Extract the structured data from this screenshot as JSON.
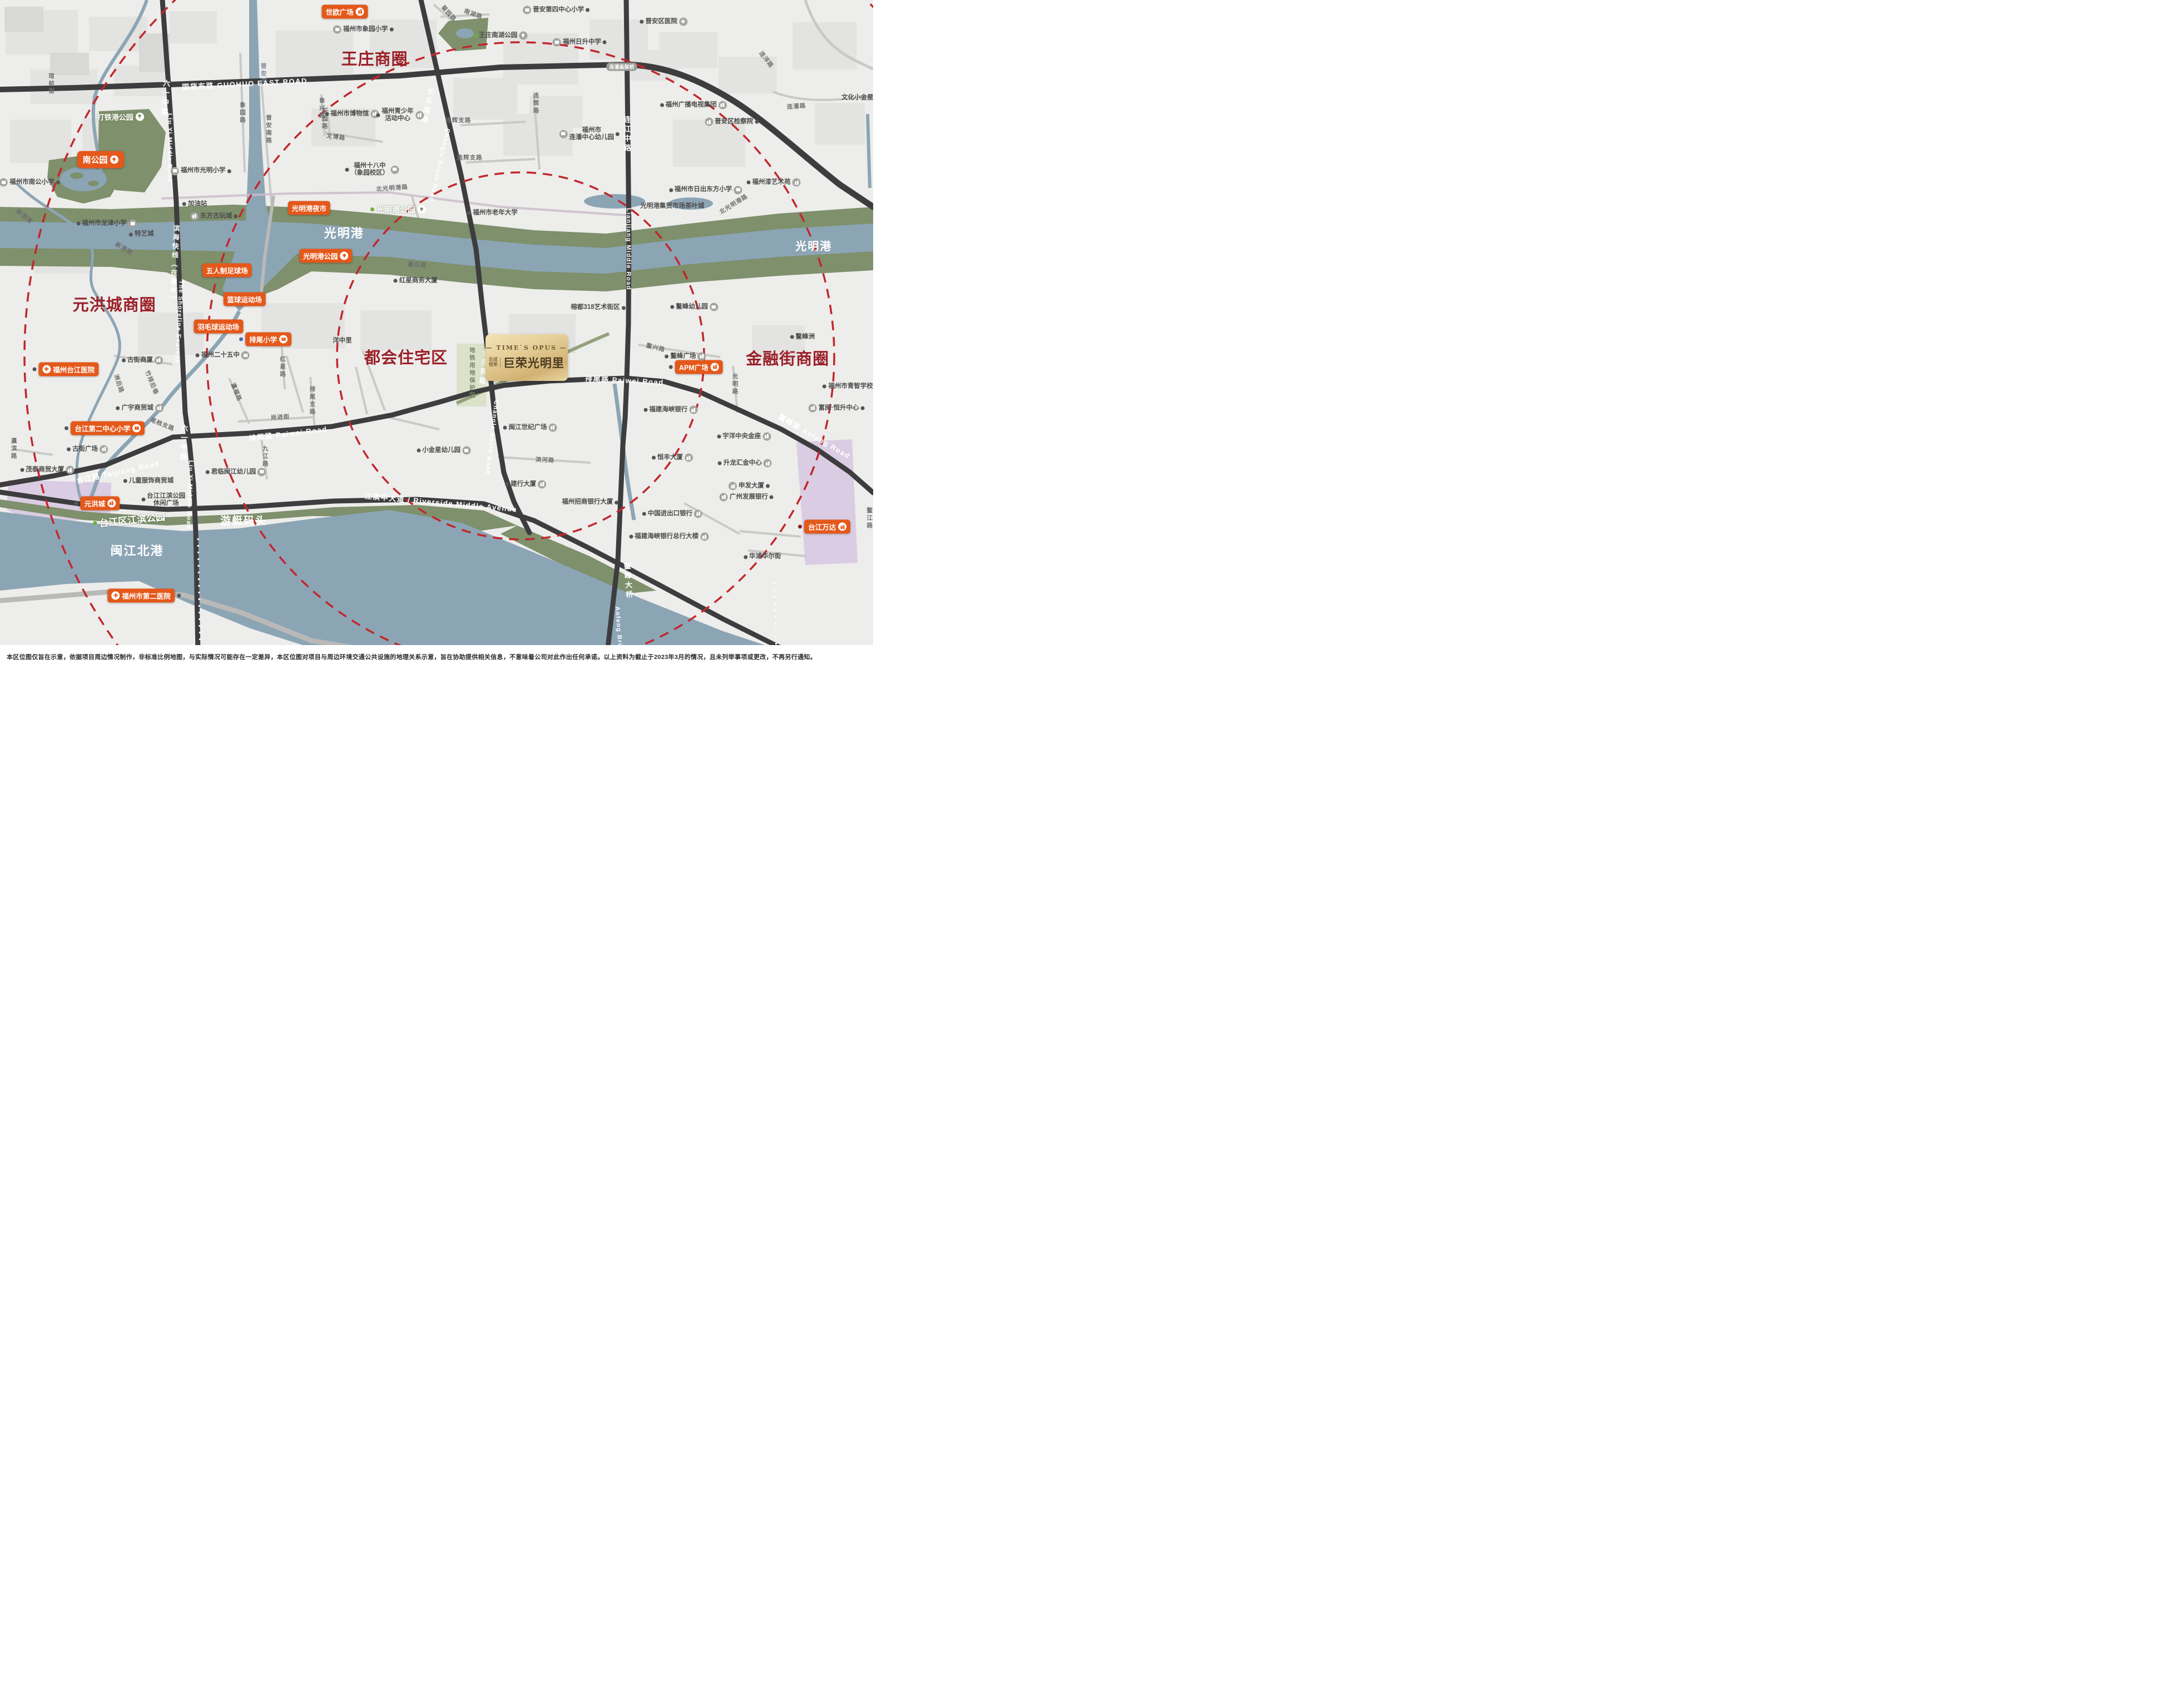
{
  "project": {
    "en_line": "— TIME`S OPUS —",
    "logo_top": "巨成",
    "logo_bottom": "恒荣",
    "name": "巨荣光明里",
    "x": 60.3,
    "y": 53.1
  },
  "disclaimer": "本区位图仅旨在示意，依据项目周边情况制作，非标准比例地图，与实际情况可能存在一定差异，本区位图对项目与周边环境交通公共设施的地理关系示意，旨在协助提供相关信息，不意味着公司对此作出任何承诺。以上资料为截止于2023年3月的情况，且未列举事项或更改，不再另行通知。",
  "colors": {
    "badge_orange": "#e4581a",
    "district_red": "#9b2028",
    "dash_red": "#c1272d",
    "water": "#8ca5b5",
    "park": "#7e906c",
    "road_dark": "#3d3d3f",
    "gold": "#d2b272"
  },
  "districts": [
    {
      "t": "王庄商圈",
      "x": 42.9,
      "y": 8.6
    },
    {
      "t": "元洪城商圈",
      "x": 13.1,
      "y": 45.1
    },
    {
      "t": "都会住宅区",
      "x": 46.5,
      "y": 52.9
    },
    {
      "t": "金融街商圈",
      "x": 90.2,
      "y": 53.1
    }
  ],
  "water_labels": [
    {
      "t": "光明港",
      "x": 39.4,
      "y": 34.5,
      "fs": 22
    },
    {
      "t": "光明港",
      "x": 93.2,
      "y": 36.4,
      "fs": 20
    },
    {
      "t": "闽江北港",
      "x": 15.7,
      "y": 81.7,
      "fs": 22
    },
    {
      "t": "游艇码头",
      "x": 27.9,
      "y": 77.2,
      "fs": 19
    }
  ],
  "park_labels": [
    {
      "t": "打铁港公园",
      "x": 13.8,
      "y": 17.3,
      "fs": 13,
      "icon": "tree"
    },
    {
      "t": "光明港公园",
      "x": 45.6,
      "y": 31.1,
      "fs": 14,
      "icon": "tree",
      "dc": "#6fae3e"
    },
    {
      "t": "台江区江滨公园",
      "x": 14.8,
      "y": 77.1,
      "fs": 17,
      "rot": -6,
      "dc": "#6fae3e"
    }
  ],
  "badges": [
    {
      "t": "世欧广场",
      "x": 39.5,
      "y": 1.7,
      "icon": "building",
      "is": "r"
    },
    {
      "t": "南公园",
      "x": 11.5,
      "y": 23.7,
      "icon": "tree",
      "is": "r",
      "size": "l"
    },
    {
      "t": "光明港夜市",
      "x": 35.4,
      "y": 30.9
    },
    {
      "t": "光明港公园",
      "x": 37.3,
      "y": 38.0,
      "icon": "tree",
      "is": "r"
    },
    {
      "t": "五人制足球场",
      "x": 26.0,
      "y": 40.1
    },
    {
      "t": "篮球运动场",
      "x": 28.0,
      "y": 44.4
    },
    {
      "t": "羽毛球运动场",
      "x": 25.0,
      "y": 48.5
    },
    {
      "t": "排尾小学",
      "x": 30.4,
      "y": 50.4,
      "icon": "book",
      "is": "r",
      "dot": "l",
      "dc": "#3a6fb0"
    },
    {
      "t": "福州台江医院",
      "x": 7.5,
      "y": 54.8,
      "icon": "cross",
      "is": "l",
      "dot": "l"
    },
    {
      "t": "台江第二中心小学",
      "x": 12.0,
      "y": 63.6,
      "icon": "book",
      "is": "r",
      "dot": "l"
    },
    {
      "t": "元洪城",
      "x": 11.1,
      "y": 74.7,
      "icon": "building",
      "is": "r",
      "dot": "l"
    },
    {
      "t": "福州市第二医院",
      "x": 16.5,
      "y": 88.4,
      "icon": "cross",
      "is": "l",
      "dot": "r"
    },
    {
      "t": "APM广场",
      "x": 79.7,
      "y": 54.5,
      "icon": "building",
      "is": "r",
      "dot": "l"
    },
    {
      "t": "台江万达",
      "x": 94.4,
      "y": 78.2,
      "icon": "building",
      "is": "r",
      "dot": "l",
      "dc": "#8b1f1f"
    }
  ],
  "pois": [
    {
      "t": "福州市象园小学",
      "x": 41.6,
      "y": 4.4,
      "icon": "book",
      "is": "l",
      "dot": "r"
    },
    {
      "t": "福州市博物馆",
      "x": 40.3,
      "y": 16.9,
      "icon": "building",
      "is": "r",
      "dot": "l"
    },
    {
      "t": "福州青少年\n活动中心",
      "x": 45.8,
      "y": 17.1,
      "icon": "building",
      "is": "r",
      "dot": "l"
    },
    {
      "t": "福州十八中\n（象园校区）",
      "x": 42.6,
      "y": 25.2,
      "icon": "book",
      "is": "r",
      "dot": "l"
    },
    {
      "t": "福州市光明小学",
      "x": 23.0,
      "y": 25.4,
      "icon": "book",
      "is": "l",
      "dot": "r"
    },
    {
      "t": "晋安第四中心小学",
      "x": 63.7,
      "y": 1.5,
      "icon": "book",
      "is": "l",
      "dot": "r"
    },
    {
      "t": "福州日升中学",
      "x": 66.4,
      "y": 6.3,
      "icon": "book",
      "is": "l",
      "dot": "r"
    },
    {
      "t": "王庄南湖公园",
      "x": 57.3,
      "y": 5.3,
      "icon": "tree",
      "is": "r",
      "dot": "l",
      "dc": "#6fae3e"
    },
    {
      "t": "福州市\n连潘中心幼儿园",
      "x": 67.5,
      "y": 19.9,
      "icon": "book",
      "is": "l",
      "dot": "r"
    },
    {
      "t": "晋安区医院",
      "x": 76.0,
      "y": 3.2,
      "icon": "cross",
      "is": "r",
      "dot": "l"
    },
    {
      "t": "福州广播电视集团",
      "x": 79.4,
      "y": 15.6,
      "icon": "building",
      "is": "r",
      "dot": "l"
    },
    {
      "t": "晋安区检察院",
      "x": 83.8,
      "y": 18.1,
      "icon": "building",
      "is": "l",
      "dot": "r"
    },
    {
      "t": "文化小金星幼儿园",
      "x": 99.3,
      "y": 14.5
    },
    {
      "t": "福州漆艺术苑",
      "x": 88.6,
      "y": 27.1,
      "icon": "building",
      "is": "r",
      "dot": "l"
    },
    {
      "t": "福州市日出东方小学",
      "x": 80.8,
      "y": 28.2,
      "icon": "book",
      "is": "r",
      "dot": "l"
    },
    {
      "t": "光明港集贸市场茶叶城",
      "x": 77.0,
      "y": 30.6
    },
    {
      "t": "鳌峰幼儿园",
      "x": 79.5,
      "y": 45.6,
      "icon": "book",
      "is": "r",
      "dot": "l"
    },
    {
      "t": "鳌峰洲",
      "x": 91.9,
      "y": 50.0,
      "dot": "l"
    },
    {
      "t": "福州市老年大学",
      "x": 56.4,
      "y": 31.6,
      "dot": "l"
    },
    {
      "t": "榕都318艺术街区",
      "x": 68.5,
      "y": 45.7,
      "dot": "r"
    },
    {
      "t": "加油站",
      "x": 22.3,
      "y": 30.3,
      "dot": "l"
    },
    {
      "t": "东方古玩城",
      "x": 24.5,
      "y": 32.1,
      "icon": "building",
      "is": "l",
      "dot": "r"
    },
    {
      "t": "福州市南公小学",
      "x": 3.4,
      "y": 27.1,
      "icon": "book",
      "is": "l",
      "dot": "r"
    },
    {
      "t": "福州市龙津小学",
      "x": 12.2,
      "y": 33.2,
      "icon": "book",
      "is": "r",
      "dot": "l"
    },
    {
      "t": "特艺城",
      "x": 16.2,
      "y": 34.8,
      "dot": "l"
    },
    {
      "t": "古街商厦",
      "x": 16.3,
      "y": 53.5,
      "icon": "building",
      "is": "r",
      "dot": "l"
    },
    {
      "t": "广宇商贸城",
      "x": 16.0,
      "y": 60.6,
      "icon": "building",
      "is": "r",
      "dot": "l"
    },
    {
      "t": "古街广场",
      "x": 10.0,
      "y": 66.7,
      "icon": "building",
      "is": "r",
      "dot": "l"
    },
    {
      "t": "茂泰商贸大厦",
      "x": 5.4,
      "y": 69.8,
      "icon": "building",
      "is": "r",
      "dot": "l"
    },
    {
      "t": "儿童服饰商贸城",
      "x": 17.0,
      "y": 71.4,
      "dot": "l"
    },
    {
      "t": "台江江滨公园\n休闲广场",
      "x": 18.7,
      "y": 74.2,
      "dot": "l"
    },
    {
      "t": "君临闽江幼儿园",
      "x": 27.0,
      "y": 70.1,
      "icon": "book",
      "is": "r",
      "dot": "l"
    },
    {
      "t": "福州二十五中",
      "x": 25.5,
      "y": 52.8,
      "icon": "book",
      "is": "r",
      "dot": "l"
    },
    {
      "t": "洋中里",
      "x": 39.2,
      "y": 50.6
    },
    {
      "t": "红星商务大厦",
      "x": 47.6,
      "y": 41.7,
      "dot": "l"
    },
    {
      "t": "闽江世纪广场",
      "x": 60.7,
      "y": 63.5,
      "icon": "building",
      "is": "r",
      "dot": "l"
    },
    {
      "t": "建行大厦",
      "x": 60.2,
      "y": 71.9,
      "icon": "building",
      "is": "r",
      "dot": "l"
    },
    {
      "t": "福州招商银行大厦",
      "x": 67.6,
      "y": 74.6,
      "dot": "r"
    },
    {
      "t": "小金星幼儿园",
      "x": 50.8,
      "y": 66.9,
      "icon": "book",
      "is": "r",
      "dot": "l"
    },
    {
      "t": "福建海峡银行",
      "x": 76.8,
      "y": 60.9,
      "icon": "building",
      "is": "r",
      "dot": "l"
    },
    {
      "t": "富闽·恒升中心",
      "x": 95.8,
      "y": 60.6,
      "icon": "building",
      "is": "l",
      "dot": "r"
    },
    {
      "t": "福州市青智学校",
      "x": 97.1,
      "y": 57.4,
      "dot": "l"
    },
    {
      "t": "宇洋中央金座",
      "x": 85.2,
      "y": 64.8,
      "icon": "building",
      "is": "r",
      "dot": "l"
    },
    {
      "t": "恒丰大厦",
      "x": 77.0,
      "y": 68.0,
      "icon": "building",
      "is": "r",
      "dot": "l"
    },
    {
      "t": "升龙汇金中心",
      "x": 85.3,
      "y": 68.8,
      "icon": "building",
      "is": "r",
      "dot": "l"
    },
    {
      "t": "申发大厦",
      "x": 85.8,
      "y": 72.2,
      "icon": "building",
      "is": "l",
      "dot": "r"
    },
    {
      "t": "广州发展银行",
      "x": 85.5,
      "y": 73.8,
      "icon": "building",
      "is": "l",
      "dot": "r"
    },
    {
      "t": "中国进出口银行",
      "x": 77.0,
      "y": 76.3,
      "icon": "building",
      "is": "r",
      "dot": "l"
    },
    {
      "t": "福建海峡银行总行大楼",
      "x": 76.6,
      "y": 79.7,
      "icon": "building",
      "is": "r",
      "dot": "l"
    },
    {
      "t": "华浦华尔街",
      "x": 87.3,
      "y": 82.7,
      "dot": "l"
    },
    {
      "t": "鳌峰广场",
      "x": 78.5,
      "y": 52.9,
      "icon": "building",
      "is": "r",
      "dot": "l"
    }
  ],
  "street_labels": [
    {
      "t": "琯前街",
      "x": 5.9,
      "y": 12.5,
      "v": 1
    },
    {
      "t": "晋安河",
      "x": 30.2,
      "y": 11.0,
      "v": 1,
      "c": "#7f8d99"
    },
    {
      "t": "象园路",
      "x": 27.8,
      "y": 16.8,
      "v": 1
    },
    {
      "t": "晋安南路",
      "x": 30.8,
      "y": 19.2,
      "v": 1
    },
    {
      "t": "象兴路",
      "x": 36.9,
      "y": 16.1,
      "v": 1
    },
    {
      "t": "乐园路",
      "x": 37.2,
      "y": 17.7,
      "v": 1
    },
    {
      "t": "文博路",
      "x": 38.5,
      "y": 20.3,
      "rot": 8
    },
    {
      "t": "菊园路",
      "x": 51.4,
      "y": 2.0,
      "rot": 48
    },
    {
      "t": "南湖路",
      "x": 54.2,
      "y": 2.1,
      "rot": 20
    },
    {
      "t": "连辉路",
      "x": 61.4,
      "y": 15.4,
      "v": 1
    },
    {
      "t": "连辉支路",
      "x": 52.5,
      "y": 17.8
    },
    {
      "t": "连辉支路",
      "x": 53.8,
      "y": 23.4
    },
    {
      "t": "连潘路",
      "x": 91.2,
      "y": 15.8,
      "rot": -4
    },
    {
      "t": "连洋路",
      "x": 87.8,
      "y": 8.8,
      "rot": 52
    },
    {
      "t": "北光明港路",
      "x": 44.9,
      "y": 27.9,
      "rot": -4
    },
    {
      "t": "北光明港路",
      "x": 84.0,
      "y": 30.3,
      "rot": -32
    },
    {
      "t": "瀛东路",
      "x": 47.8,
      "y": 39.3,
      "rot": 3
    },
    {
      "t": "红星路",
      "x": 32.4,
      "y": 54.5,
      "v": 1
    },
    {
      "t": "新港道",
      "x": 2.8,
      "y": 32.1,
      "rot": 38
    },
    {
      "t": "新港街",
      "x": 14.2,
      "y": 36.9,
      "rot": 30
    },
    {
      "t": "洲后路",
      "x": 13.6,
      "y": 57.0,
      "rot": 72
    },
    {
      "t": "竹排后巷",
      "x": 17.4,
      "y": 56.8,
      "rot": 68
    },
    {
      "t": "尾档支路",
      "x": 18.6,
      "y": 63.0,
      "rot": 22
    },
    {
      "t": "瀛滨路",
      "x": 1.6,
      "y": 66.6,
      "v": 1
    },
    {
      "t": "瀛福路",
      "x": 27.1,
      "y": 58.2,
      "rot": 68
    },
    {
      "t": "排尾支路",
      "x": 35.8,
      "y": 59.5,
      "v": 1
    },
    {
      "t": "尚进街",
      "x": 32.1,
      "y": 61.9,
      "rot": -3
    },
    {
      "t": "九江路",
      "x": 30.4,
      "y": 67.8,
      "v": 1
    },
    {
      "t": "滨河路",
      "x": 62.4,
      "y": 68.3,
      "rot": 3
    },
    {
      "t": "光明路",
      "x": 84.2,
      "y": 57.1,
      "v": 1
    },
    {
      "t": "鳌兴路",
      "x": 75.1,
      "y": 51.6,
      "rot": 14
    },
    {
      "t": "鳌江路",
      "x": 99.6,
      "y": 77.0,
      "v": 1
    }
  ],
  "road_labels": [
    {
      "t": "国货东路  GUOHUO EAST ROAD",
      "x": 28.0,
      "y": 12.4,
      "rot": -3,
      "fs": 13
    },
    {
      "t": "六一中路",
      "x": 18.9,
      "y": 14.6,
      "v": 1,
      "rot": 3
    },
    {
      "t": "Liu Yi Middle Road",
      "x": 19.4,
      "y": 22.0,
      "rot": 90,
      "fs": 11
    },
    {
      "t": "滨海快线（在建中）",
      "x": 20.0,
      "y": 39.3,
      "v": 1,
      "rot": 3,
      "fs": 12
    },
    {
      "t": "The Shoreline Express",
      "x": 20.5,
      "y": 47.8,
      "rot": 93,
      "fs": 11
    },
    {
      "t": "六一中路",
      "x": 21.0,
      "y": 65.8,
      "v": 1,
      "rot": 2
    },
    {
      "t": "Liu Yi Middle Road",
      "x": 21.7,
      "y": 73.5,
      "rot": 92,
      "fs": 11
    },
    {
      "t": "长乐南路",
      "x": 48.9,
      "y": 15.8,
      "v": 1,
      "rot": 12
    },
    {
      "t": "Changle South Road",
      "x": 50.3,
      "y": 24.5,
      "rot": 103,
      "fs": 11
    },
    {
      "t": "长乐南路",
      "x": 55.4,
      "y": 54.6,
      "v": 1,
      "rot": 7
    },
    {
      "t": "Changle South Road",
      "x": 56.3,
      "y": 65.0,
      "rot": 97,
      "fs": 11
    },
    {
      "t": "连江中路",
      "x": 71.8,
      "y": 20.0,
      "v": 1
    },
    {
      "t": "Lianjiang Middle Road",
      "x": 72.0,
      "y": 37.0,
      "rot": 90,
      "fs": 11
    },
    {
      "t": "鳌峰大桥",
      "x": 71.9,
      "y": 86.3,
      "v": 1,
      "rot": -4
    },
    {
      "t": "Aofeng Bridge",
      "x": 70.9,
      "y": 94.0,
      "rot": 86,
      "fs": 11
    },
    {
      "t": "排尾路  Paiwei Road",
      "x": 33.0,
      "y": 64.3,
      "rot": -7,
      "fs": 13
    },
    {
      "t": "排尾路  Paiwei Road",
      "x": 71.5,
      "y": 56.4,
      "rot": 3,
      "fs": 13
    },
    {
      "t": "台江路  Taijiang Road",
      "x": 13.5,
      "y": 70.0,
      "rot": -12,
      "fs": 13
    },
    {
      "t": "江滨中大道 / Riverside Middle Avenue",
      "x": 50.5,
      "y": 74.6,
      "rot": 5,
      "fs": 13
    },
    {
      "t": "鳌峰路  Aofeng Road",
      "x": 93.3,
      "y": 64.7,
      "rot": 30,
      "fs": 13
    }
  ],
  "mini_badges": [
    {
      "t": "连潘高架桥",
      "x": 71.2,
      "y": 9.9,
      "style": "g"
    },
    {
      "t": "城市漫步道",
      "x": 60.8,
      "y": 51.9,
      "style": "w",
      "icon": "tree"
    },
    {
      "t": "地铁用地保护区",
      "x": 54.1,
      "y": 55.4,
      "style": "zone"
    }
  ]
}
